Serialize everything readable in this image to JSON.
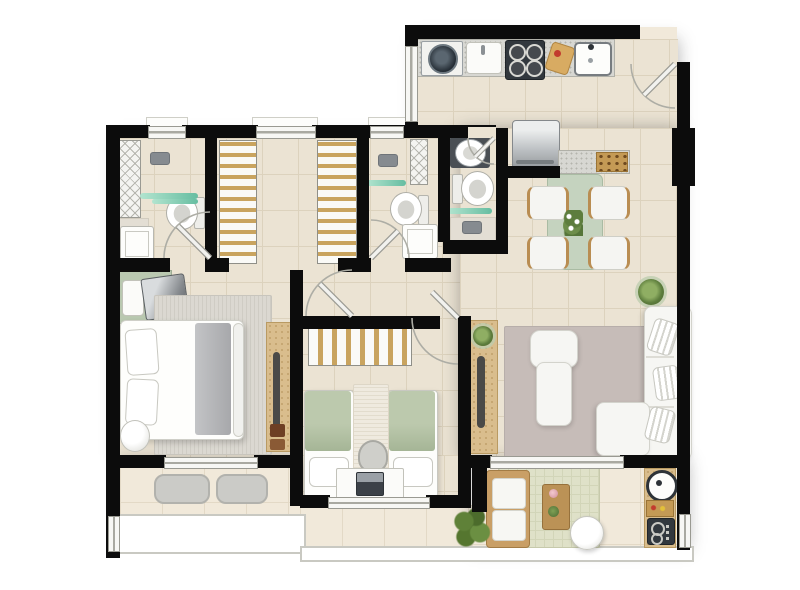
{
  "type": "floor-plan",
  "subject": "Furnished two-bedroom apartment floor plan, top-down illustrated view, no text labels",
  "palette": {
    "background": "#ffffff",
    "wall": "#0c0c0c",
    "floor": "#ebe3d3",
    "floor_grid": "#dcd2bd",
    "balcony_floor": "#f1e9da",
    "window": "#f7f7f4",
    "window_frame": "#9a9a92",
    "door_arc": "#adada5",
    "granite": "#d7d7d2",
    "appliance_dark": "#32383e",
    "steel": "#c2c6c9",
    "wood": "#d9bd8d",
    "wood_dark": "#b98d52",
    "sage": "#c5d3bf",
    "bed_green": "#b3c2a4",
    "teal_glass": "#8fd2ba",
    "rug_master": "#dbd8d1",
    "rug_living": "#c6bcb8",
    "rug_gourmet": "#dfe1c8",
    "sofa_white": "#f6f6f3",
    "plant_green": "#5d7d3d",
    "shadow": "rgba(40,40,40,0.35)"
  },
  "rooms": [
    {
      "id": "kitchen-laundry",
      "furniture": [
        "granite-counter",
        "washing-machine",
        "laundry-sink",
        "stove-4-burners",
        "cutting-board",
        "kitchen-sink",
        "entrance-door"
      ]
    },
    {
      "id": "dining-area",
      "furniture": [
        "refrigerator",
        "buffet-counter",
        "serving-tray",
        "dining-table",
        "dining-chair-x4",
        "flower-centerpiece",
        "potted-plant"
      ]
    },
    {
      "id": "living-room",
      "furniture": [
        "tv-sideboard",
        "sideboard-plant",
        "area-rug",
        "chaise-armchair",
        "l-shaped-sofa",
        "striped-pillow-x3"
      ]
    },
    {
      "id": "master-bedroom",
      "furniture": [
        "double-bed",
        "bed-pillow-x2",
        "gray-blanket",
        "area-rug",
        "dresser-with-tv",
        "tall-cabinet",
        "round-pouf",
        "slipper-mat-x2"
      ]
    },
    {
      "id": "second-bedroom",
      "furniture": [
        "twin-bed-x2",
        "wardrobe",
        "runner-rug",
        "desk",
        "laptop",
        "desk-chair"
      ]
    },
    {
      "id": "bathroom-master",
      "furniture": [
        "shelf-unit",
        "shower-head",
        "shower-floor",
        "glass-shelf",
        "toilet",
        "vanity-sink",
        "door"
      ]
    },
    {
      "id": "walk-in-closet",
      "furniture": [
        "wardrobe-left",
        "wardrobe-right",
        "window"
      ]
    },
    {
      "id": "bathroom-2",
      "furniture": [
        "duct-shaft",
        "shower-head",
        "glass-shelf",
        "toilet",
        "vanity-sink",
        "door"
      ]
    },
    {
      "id": "bathroom-3",
      "furniture": [
        "counter-basin",
        "toilet",
        "glass-shelf",
        "shower-head",
        "door"
      ]
    },
    {
      "id": "balcony",
      "furniture": [
        "floor-mat-x2",
        "glass-railing"
      ]
    },
    {
      "id": "gourmet-balcony",
      "furniture": [
        "wood-sofa",
        "area-rug",
        "coffee-table",
        "round-side-table",
        "leafy-plant",
        "grill-counter",
        "barbecue-grill",
        "food-tray",
        "cooktop",
        "glass-railing"
      ]
    }
  ]
}
